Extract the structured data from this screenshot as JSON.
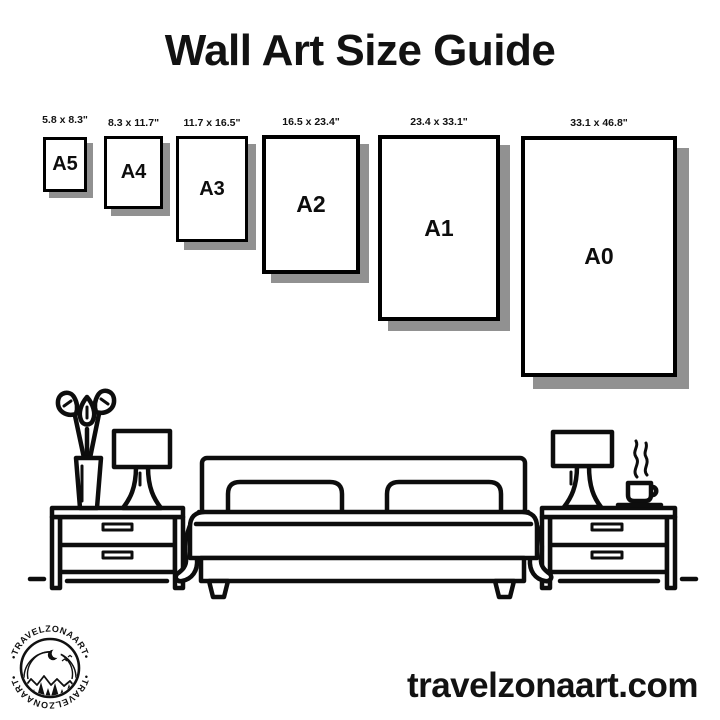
{
  "title": "Wall Art Size Guide",
  "sizes": {
    "items": [
      {
        "name": "A5",
        "dimensions": "5.8 x 8.3\""
      },
      {
        "name": "A4",
        "dimensions": "8.3 x 11.7\""
      },
      {
        "name": "A3",
        "dimensions": "11.7 x 16.5\""
      },
      {
        "name": "A2",
        "dimensions": "16.5 x 23.4\""
      },
      {
        "name": "A1",
        "dimensions": "23.4 x 33.1\""
      },
      {
        "name": "A0",
        "dimensions": "33.1 x 46.8\""
      }
    ]
  },
  "brand": {
    "badge_text_top": "•TRAVELZONAART•",
    "badge_text_bottom": "•TRAVELZONAART•",
    "website": "travelzonaart.com"
  },
  "illustration": {
    "elements": [
      "plant-vase",
      "table-lamp",
      "nightstand",
      "double-bed-with-pillows",
      "coffee-cup-with-steam",
      "nightstand",
      "floor-line"
    ]
  },
  "colors": {
    "ink": "#0d0d0d",
    "shadow": "#919191",
    "background": "#ffffff"
  }
}
